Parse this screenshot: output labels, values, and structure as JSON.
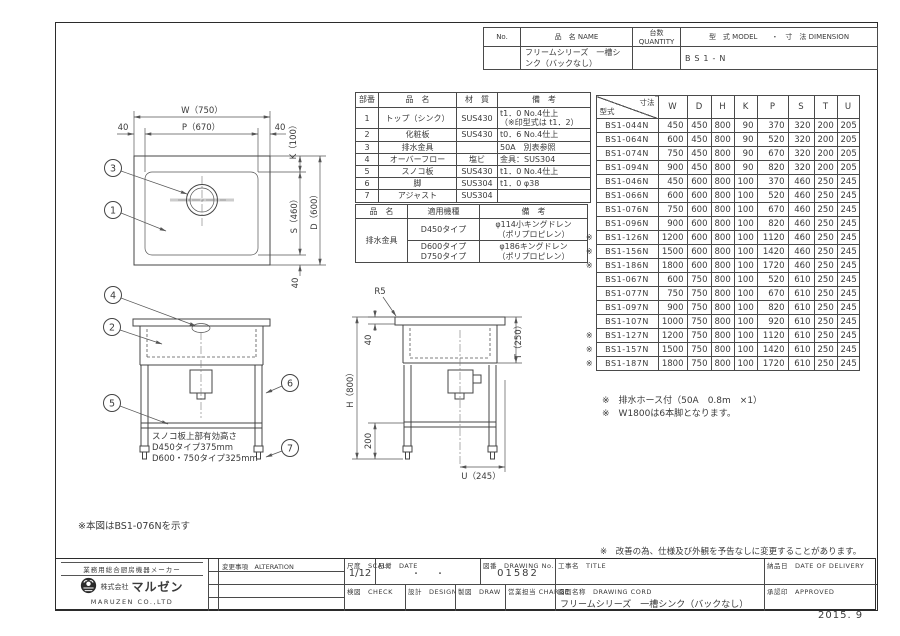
{
  "header_table": {
    "no_label": "No.",
    "name_label": "品　名 NAME",
    "qty_label": "台数 QUANTITY",
    "model_label": "型　式 MODEL　　・　寸　法 DIMENSION",
    "name_value": "フリームシリーズ　一槽シンク（バックなし）",
    "model_value": "BS1-N"
  },
  "parts_table": {
    "headers": [
      "部番",
      "品　名",
      "材　質",
      "備　考"
    ],
    "rows": [
      {
        "no": "1",
        "name": "トップ（シンク）",
        "material": "SUS430",
        "remark": "t1．0 No.4仕上\n（※印型式は t1．2）"
      },
      {
        "no": "2",
        "name": "化粧板",
        "material": "SUS430",
        "remark": "t0．6 No.4仕上"
      },
      {
        "no": "3",
        "name": "排水金具",
        "material": "",
        "remark": "50A　別表参照"
      },
      {
        "no": "4",
        "name": "オーバーフロー",
        "material": "塩ビ",
        "remark": "金具：SUS304"
      },
      {
        "no": "5",
        "name": "スノコ板",
        "material": "SUS430",
        "remark": "t1．0 No.4仕上"
      },
      {
        "no": "6",
        "name": "脚",
        "material": "SUS304",
        "remark": "t1．0 φ38"
      },
      {
        "no": "7",
        "name": "アジャスト",
        "material": "SUS304",
        "remark": ""
      }
    ]
  },
  "drain_table": {
    "headers": [
      "品　名",
      "適用機種",
      "備　考"
    ],
    "part_name": "排水金具",
    "rows": [
      {
        "model": "D450タイプ",
        "remark": "φ114小キングドレン\n（ポリプロピレン）"
      },
      {
        "model": "D600タイプ\nD750タイプ",
        "remark": "φ186キングドレン\n（ポリプロピレン）"
      }
    ]
  },
  "dim_table": {
    "corner_top": "寸法",
    "corner_bottom": "型式",
    "mark": "※",
    "columns": [
      "W",
      "D",
      "H",
      "K",
      "P",
      "S",
      "T",
      "U"
    ],
    "rows": [
      {
        "marked": false,
        "model": "BS1-044N",
        "values": [
          450,
          450,
          800,
          90,
          370,
          320,
          200,
          205
        ]
      },
      {
        "marked": false,
        "model": "BS1-064N",
        "values": [
          600,
          450,
          800,
          90,
          520,
          320,
          200,
          205
        ]
      },
      {
        "marked": false,
        "model": "BS1-074N",
        "values": [
          750,
          450,
          800,
          90,
          670,
          320,
          200,
          205
        ]
      },
      {
        "marked": false,
        "model": "BS1-094N",
        "values": [
          900,
          450,
          800,
          90,
          820,
          320,
          200,
          205
        ]
      },
      {
        "marked": false,
        "model": "BS1-046N",
        "values": [
          450,
          600,
          800,
          100,
          370,
          460,
          250,
          245
        ]
      },
      {
        "marked": false,
        "model": "BS1-066N",
        "values": [
          600,
          600,
          800,
          100,
          520,
          460,
          250,
          245
        ]
      },
      {
        "marked": false,
        "model": "BS1-076N",
        "values": [
          750,
          600,
          800,
          100,
          670,
          460,
          250,
          245
        ]
      },
      {
        "marked": false,
        "model": "BS1-096N",
        "values": [
          900,
          600,
          800,
          100,
          820,
          460,
          250,
          245
        ]
      },
      {
        "marked": true,
        "model": "BS1-126N",
        "values": [
          1200,
          600,
          800,
          100,
          1120,
          460,
          250,
          245
        ]
      },
      {
        "marked": true,
        "model": "BS1-156N",
        "values": [
          1500,
          600,
          800,
          100,
          1420,
          460,
          250,
          245
        ]
      },
      {
        "marked": true,
        "model": "BS1-186N",
        "values": [
          1800,
          600,
          800,
          100,
          1720,
          460,
          250,
          245
        ]
      },
      {
        "marked": false,
        "model": "BS1-067N",
        "values": [
          600,
          750,
          800,
          100,
          520,
          610,
          250,
          245
        ]
      },
      {
        "marked": false,
        "model": "BS1-077N",
        "values": [
          750,
          750,
          800,
          100,
          670,
          610,
          250,
          245
        ]
      },
      {
        "marked": false,
        "model": "BS1-097N",
        "values": [
          900,
          750,
          800,
          100,
          820,
          610,
          250,
          245
        ]
      },
      {
        "marked": false,
        "model": "BS1-107N",
        "values": [
          1000,
          750,
          800,
          100,
          920,
          610,
          250,
          245
        ]
      },
      {
        "marked": true,
        "model": "BS1-127N",
        "values": [
          1200,
          750,
          800,
          100,
          1120,
          610,
          250,
          245
        ]
      },
      {
        "marked": true,
        "model": "BS1-157N",
        "values": [
          1500,
          750,
          800,
          100,
          1420,
          610,
          250,
          245
        ]
      },
      {
        "marked": true,
        "model": "BS1-187N",
        "values": [
          1800,
          750,
          800,
          100,
          1720,
          610,
          250,
          245
        ]
      }
    ]
  },
  "table_notes": [
    "※　排水ホース付（50A　0.8m　×1）",
    "※　W1800は6本脚となります。"
  ],
  "figure_note": "※本図はBS1-076Nを示す",
  "change_note": "※　改善の為、仕様及び外観を予告なしに変更することがあります。",
  "title_block": {
    "maker_tagline": "業務用総合厨房機器メーカー",
    "company_prefix": "株式会社",
    "company_name": "マルゼン",
    "company_en": "MARUZEN CO.,LTD",
    "alteration_label": "変更事項　ALTERATION",
    "scale_label": "尺度　SCALE",
    "scale_value": "1/12",
    "date_label": "日付　DATE",
    "date_value": "・　　・",
    "drawing_no_label": "図番　DRAWING No.",
    "drawing_no_value": "01582",
    "title_label": "工事名　TITLE",
    "delivery_label": "納品日　DATE OF DELIVERY",
    "check_label": "検図　CHECK",
    "design_label": "設計　DESIGN",
    "draw_label": "製図　DRAW",
    "charge_label": "営業担当 CHARGE",
    "drawing_name_label": "図面名称　DRAWING CORD",
    "drawing_name_value": "フリームシリーズ　一槽シンク（バックなし）",
    "approved_label": "承認印　APPROVED"
  },
  "footer_date": "2015. 9",
  "drawing": {
    "balloons": [
      "1",
      "2",
      "3",
      "4",
      "5",
      "6",
      "7"
    ],
    "plan": {
      "w": "W（750）",
      "p": "P（670）",
      "m_left": "40",
      "m_right": "40",
      "k": "K（100）",
      "s": "S（460）",
      "d": "D（600）",
      "m_bottom": "40"
    },
    "front": {
      "note1": "スノコ板上部有効高さ",
      "note2": "D450タイプ375mm",
      "note3": "D600・750タイプ325mm"
    },
    "side": {
      "r": "R5",
      "top40": "40",
      "t": "T（250）",
      "h": "H（800）",
      "leg200": "200",
      "u": "U（245）"
    }
  }
}
